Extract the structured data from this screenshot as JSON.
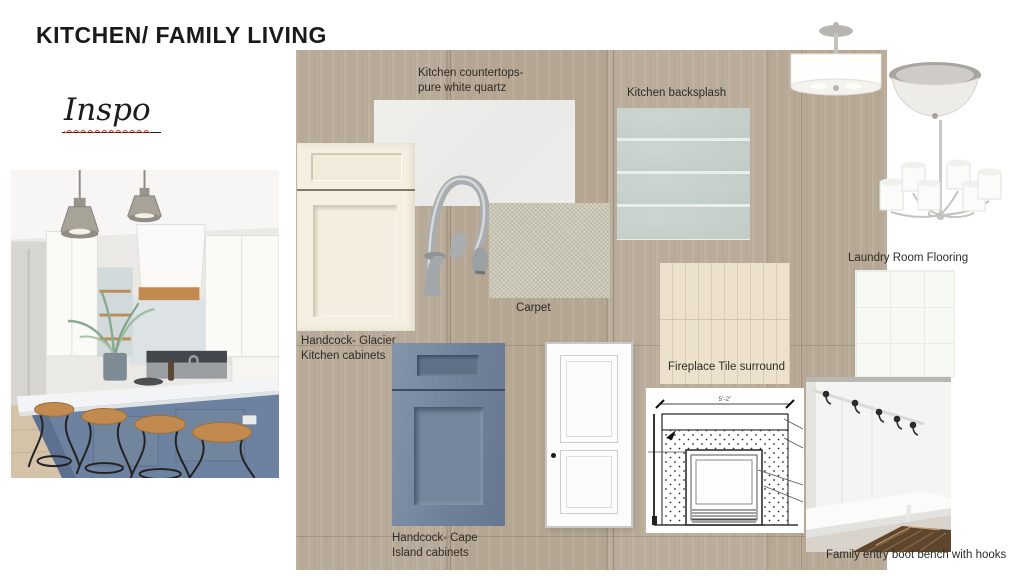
{
  "slide": {
    "title": "KITCHEN/ FAMILY LIVING",
    "inspo": "Inspo"
  },
  "labels": {
    "countertops": {
      "line1": "Kitchen countertops-",
      "line2": "pure white quartz"
    },
    "backsplash": "Kitchen backsplash",
    "glacier": {
      "line1": "Handcock- Glacier",
      "line2": "Kitchen cabinets"
    },
    "carpet": "Carpet",
    "fireplace_tile": "Fireplace Tile surround",
    "laundry": "Laundry Room Flooring",
    "cape": {
      "line1": "Handcock- Cape",
      "line2": "Island cabinets"
    },
    "bench": "Family entry boot bench with hooks"
  },
  "fireplace": {
    "dimension": "5'-2\""
  },
  "images": {
    "kitchen_photo": "kitchen-inspiration-photo",
    "quartz": "quartz-countertop-swatch",
    "backsplash": "backsplash-tile-swatch",
    "glacier_cabinet": "cream-cabinet-door-sample",
    "faucet": "brushed-nickel-faucet",
    "carpet": "carpet-swatch",
    "cape_cabinet": "blue-cabinet-door-sample",
    "door": "white-interior-door",
    "fireplace_tile": "vertical-tile-swatch",
    "fireplace_drawing": "fireplace-elevation-drawing",
    "laundry_floor": "white-tile-flooring-swatch",
    "drum_pendant": "drum-pendant-light",
    "flush_mount": "flush-mount-ceiling-light",
    "chandelier": "six-light-chandelier",
    "mudroom": "mudroom-boot-bench-photo"
  },
  "colors": {
    "wood_board": "#b3a593",
    "glacier_cream": "#f4efe1",
    "cape_blue": "#74869b",
    "backsplash_tile": "#c5cdc9",
    "carpet_beige": "#c9c5b3",
    "fireplace_tile_beige": "#eadfcb",
    "island_blue": "#6d81a0",
    "underline_red": "#d93a2c",
    "label_text": "#2f2b26",
    "title_text": "#1a1a1a"
  }
}
